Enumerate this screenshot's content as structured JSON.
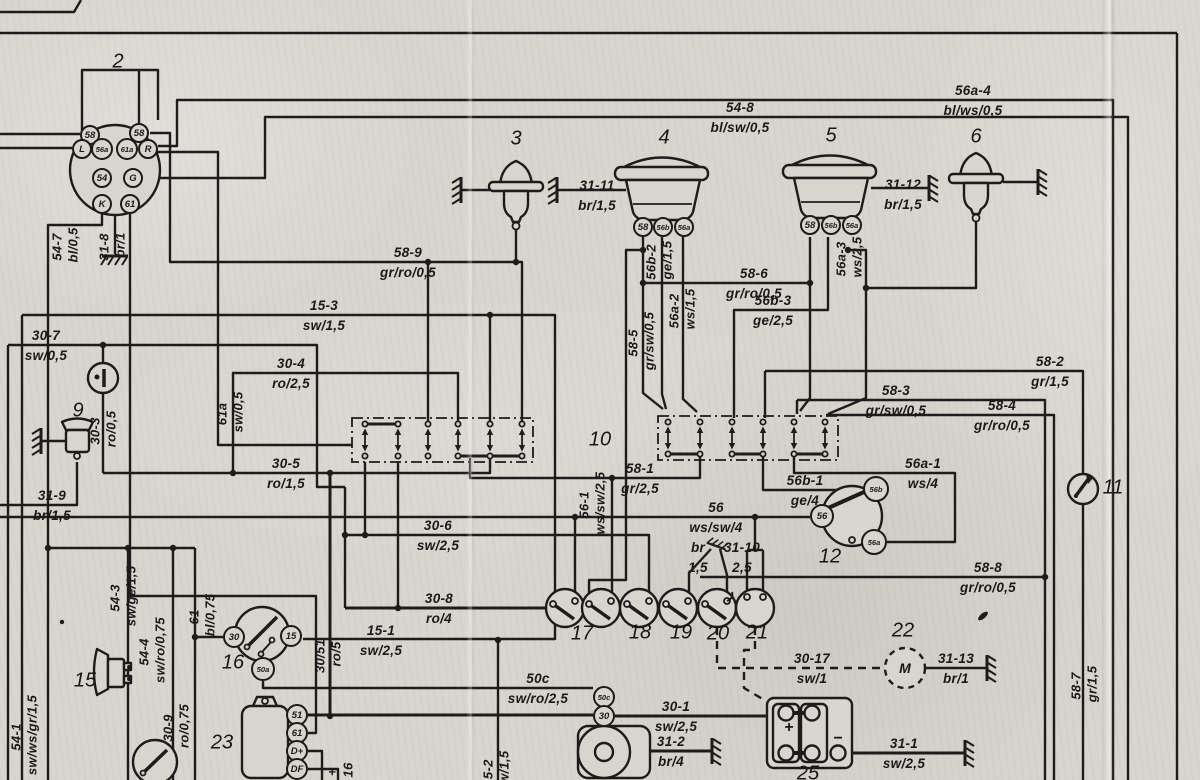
{
  "diagram": {
    "kind": "vehicle-wiring-schematic",
    "paper_color": "#d8d5cf",
    "ink_color": "#1c1c1c",
    "component_numbers": [
      {
        "t": "2",
        "x": 118,
        "y": 62
      },
      {
        "t": "3",
        "x": 516,
        "y": 139
      },
      {
        "t": "4",
        "x": 664,
        "y": 138
      },
      {
        "t": "5",
        "x": 831,
        "y": 136
      },
      {
        "t": "6",
        "x": 976,
        "y": 137
      },
      {
        "t": "9",
        "x": 78,
        "y": 411
      },
      {
        "t": "10",
        "x": 600,
        "y": 440
      },
      {
        "t": "11",
        "x": 1113,
        "y": 488
      },
      {
        "t": "12",
        "x": 830,
        "y": 557
      },
      {
        "t": "15",
        "x": 85,
        "y": 681
      },
      {
        "t": "16",
        "x": 233,
        "y": 663
      },
      {
        "t": "17",
        "x": 582,
        "y": 634
      },
      {
        "t": "18",
        "x": 640,
        "y": 633
      },
      {
        "t": "19",
        "x": 681,
        "y": 633
      },
      {
        "t": "20",
        "x": 718,
        "y": 634
      },
      {
        "t": "21",
        "x": 757,
        "y": 633
      },
      {
        "t": "22",
        "x": 903,
        "y": 631
      },
      {
        "t": "23",
        "x": 222,
        "y": 743
      },
      {
        "t": "25",
        "x": 808,
        "y": 774
      }
    ],
    "wire_labels_horizontal": [
      {
        "name": "56a-4",
        "spec": "bl/ws/0,5",
        "x": 973,
        "y": 100
      },
      {
        "name": "54-8",
        "spec": "bl/sw/0,5",
        "x": 740,
        "y": 117
      },
      {
        "name": "31-11",
        "spec": "br/1,5",
        "x": 597,
        "y": 195
      },
      {
        "name": "31-12",
        "spec": "br/1,5",
        "x": 903,
        "y": 194
      },
      {
        "name": "58-9",
        "spec": "gr/ro/0,5",
        "x": 408,
        "y": 262
      },
      {
        "name": "58-6",
        "spec": "gr/ro/0,5",
        "x": 754,
        "y": 283
      },
      {
        "name": "15-3",
        "spec": "sw/1,5",
        "x": 324,
        "y": 315
      },
      {
        "name": "56b-3",
        "spec": "ge/2,5",
        "x": 773,
        "y": 310
      },
      {
        "name": "30-7",
        "spec": "sw/0,5",
        "x": 46,
        "y": 345
      },
      {
        "name": "58-2",
        "spec": "gr/1,5",
        "x": 1050,
        "y": 371
      },
      {
        "name": "30-4",
        "spec": "ro/2,5",
        "x": 291,
        "y": 373
      },
      {
        "name": "58-3",
        "spec": "gr/sw/0,5",
        "x": 896,
        "y": 400
      },
      {
        "name": "58-4",
        "spec": "gr/ro/0,5",
        "x": 1002,
        "y": 415
      },
      {
        "name": "30-5",
        "spec": "ro/1,5",
        "x": 286,
        "y": 473
      },
      {
        "name": "58-1",
        "spec": "gr/2,5",
        "x": 640,
        "y": 478
      },
      {
        "name": "56a-1",
        "spec": "ws/4",
        "x": 923,
        "y": 473
      },
      {
        "name": "56b-1",
        "spec": "ge/4",
        "x": 805,
        "y": 490
      },
      {
        "name": "31-9",
        "spec": "br/1,5",
        "x": 52,
        "y": 505
      },
      {
        "name": "56",
        "spec": "ws/sw/4",
        "x": 716,
        "y": 517
      },
      {
        "name": "30-6",
        "spec": "sw/2,5",
        "x": 438,
        "y": 535
      },
      {
        "name": "br",
        "spec": "1,5",
        "x": 698,
        "y": 557
      },
      {
        "name": "31-10",
        "spec": "2,5",
        "x": 742,
        "y": 557
      },
      {
        "name": "58-8",
        "spec": "gr/ro/0,5",
        "x": 988,
        "y": 577
      },
      {
        "name": "30-8",
        "spec": "ro/4",
        "x": 439,
        "y": 608
      },
      {
        "name": "15-1",
        "spec": "sw/2,5",
        "x": 381,
        "y": 640
      },
      {
        "name": "30-17",
        "spec": "sw/1",
        "x": 812,
        "y": 668
      },
      {
        "name": "31-13",
        "spec": "br/1",
        "x": 956,
        "y": 668
      },
      {
        "name": "50c",
        "spec": "sw/ro/2,5",
        "x": 538,
        "y": 688
      },
      {
        "name": "30-1",
        "spec": "sw/2,5",
        "x": 676,
        "y": 716
      },
      {
        "name": "31-2",
        "spec": "br/4",
        "x": 671,
        "y": 751
      },
      {
        "name": "31-1",
        "spec": "sw/2,5",
        "x": 904,
        "y": 753
      }
    ],
    "wire_labels_vertical": [
      {
        "name": "54-7",
        "spec": "bl/0,5",
        "x": 57,
        "y": 247
      },
      {
        "name": "31-8",
        "spec": "br/1",
        "x": 104,
        "y": 247
      },
      {
        "name": "61a",
        "spec": "sw/0,5",
        "x": 222,
        "y": 414
      },
      {
        "name": "30-3",
        "spec": "ro/0,5",
        "x": 95,
        "y": 431
      },
      {
        "name": "56b-2",
        "spec": "ge/1,5",
        "x": 651,
        "y": 262
      },
      {
        "name": "56a-2",
        "spec": "ws/1,5",
        "x": 674,
        "y": 311
      },
      {
        "name": "58-5",
        "spec": "gr/sw/0,5",
        "x": 633,
        "y": 343
      },
      {
        "name": "56a-3",
        "spec": "ws/2,5",
        "x": 841,
        "y": 259
      },
      {
        "name": "56-1",
        "spec": "ws/sw/2,5",
        "x": 584,
        "y": 505
      },
      {
        "name": "54-3",
        "spec": "sw/ge/1,5",
        "x": 115,
        "y": 598
      },
      {
        "name": "54-4",
        "spec": "sw/ro/0,75",
        "x": 144,
        "y": 652
      },
      {
        "name": "54-1",
        "spec": "sw/ws/gr/1,5",
        "x": 16,
        "y": 737
      },
      {
        "name": "61",
        "spec": "bl/0,75",
        "x": 194,
        "y": 617
      },
      {
        "name": "30-9",
        "spec": "ro/0,75",
        "x": 168,
        "y": 728
      },
      {
        "name": "30/51",
        "spec": "ro/5",
        "x": 320,
        "y": 656
      },
      {
        "name": "58-7",
        "spec": "gr/1,5",
        "x": 1076,
        "y": 686
      },
      {
        "name": "15-2",
        "spec": "sw/1,5",
        "x": 488,
        "y": 773
      },
      {
        "name": "+",
        "spec": "16",
        "x": 332,
        "y": 772
      }
    ],
    "terminals": [
      {
        "t": "58",
        "x": 90,
        "y": 135,
        "r": 10
      },
      {
        "t": "58",
        "x": 139,
        "y": 133,
        "r": 10
      },
      {
        "t": "L",
        "x": 82,
        "y": 149,
        "r": 10
      },
      {
        "t": "56a",
        "x": 102,
        "y": 149,
        "r": 11
      },
      {
        "t": "61a",
        "x": 127,
        "y": 149,
        "r": 11
      },
      {
        "t": "R",
        "x": 148,
        "y": 149,
        "r": 10
      },
      {
        "t": "54",
        "x": 102,
        "y": 178,
        "r": 10
      },
      {
        "t": "G",
        "x": 133,
        "y": 178,
        "r": 10
      },
      {
        "t": "K",
        "x": 102,
        "y": 204,
        "r": 10
      },
      {
        "t": "61",
        "x": 130,
        "y": 204,
        "r": 10
      },
      {
        "t": "58",
        "x": 643,
        "y": 227,
        "r": 10
      },
      {
        "t": "56b",
        "x": 663,
        "y": 227,
        "r": 10
      },
      {
        "t": "56a",
        "x": 684,
        "y": 227,
        "r": 10
      },
      {
        "t": "58",
        "x": 810,
        "y": 225,
        "r": 10
      },
      {
        "t": "56b",
        "x": 831,
        "y": 225,
        "r": 10
      },
      {
        "t": "56a",
        "x": 852,
        "y": 225,
        "r": 10
      },
      {
        "t": "30",
        "x": 234,
        "y": 637,
        "r": 11
      },
      {
        "t": "15",
        "x": 291,
        "y": 636,
        "r": 11
      },
      {
        "t": "50a",
        "x": 263,
        "y": 669,
        "r": 12
      },
      {
        "t": "56b",
        "x": 876,
        "y": 489,
        "r": 13
      },
      {
        "t": "56",
        "x": 822,
        "y": 516,
        "r": 12
      },
      {
        "t": "56a",
        "x": 874,
        "y": 542,
        "r": 13
      },
      {
        "t": "51",
        "x": 297,
        "y": 715,
        "r": 11
      },
      {
        "t": "61",
        "x": 297,
        "y": 733,
        "r": 11
      },
      {
        "t": "D+",
        "x": 297,
        "y": 751,
        "r": 11
      },
      {
        "t": "DF",
        "x": 297,
        "y": 769,
        "r": 11
      },
      {
        "t": "50c",
        "x": 604,
        "y": 697,
        "r": 11
      },
      {
        "t": "30",
        "x": 604,
        "y": 716,
        "r": 11
      }
    ],
    "symbols": [
      {
        "t": "+",
        "x": 789,
        "y": 728,
        "fs": 16
      },
      {
        "t": "−",
        "x": 838,
        "y": 739,
        "fs": 16
      },
      {
        "t": "M",
        "x": 905,
        "y": 668,
        "fs": 14,
        "italic": true
      }
    ]
  }
}
